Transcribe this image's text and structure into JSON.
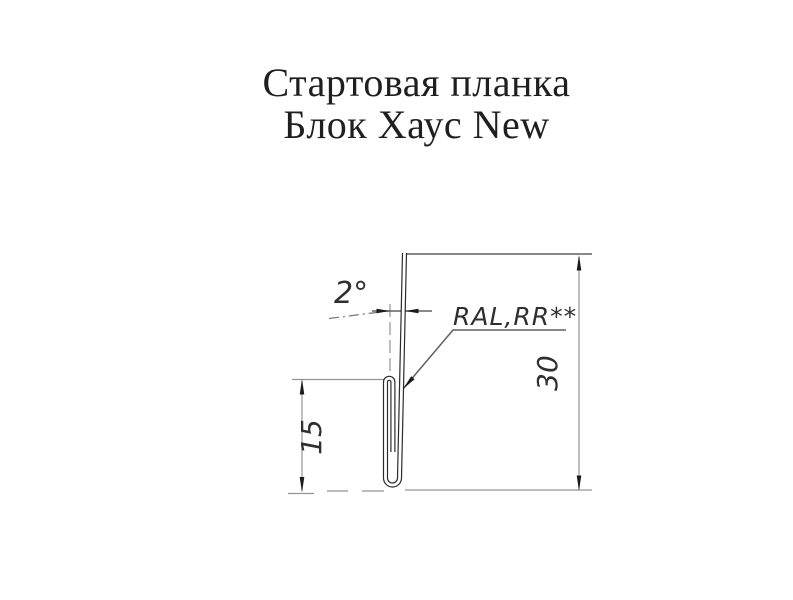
{
  "title": {
    "line1": "Стартовая планка",
    "line2": "Блок Хаус New"
  },
  "drawing": {
    "type": "technical-profile-cross-section",
    "labels": {
      "angle": "2°",
      "coating": "RAL,RR**",
      "profile_height": "30",
      "flange_height": "15"
    },
    "dimensions": {
      "angle_deg": 2,
      "profile_height_mm": 30,
      "flange_height_mm": 15
    },
    "colors": {
      "background": "#ffffff",
      "profile": "#2b2b2b",
      "profile_core": "#ffffff",
      "dim_line": "#949494",
      "medium_line": "#606060",
      "dashdot_line": "#7d7d7d",
      "arrow": "#1b1b1b",
      "label": "#2f2f2f",
      "title": "#1f1f1f"
    }
  }
}
